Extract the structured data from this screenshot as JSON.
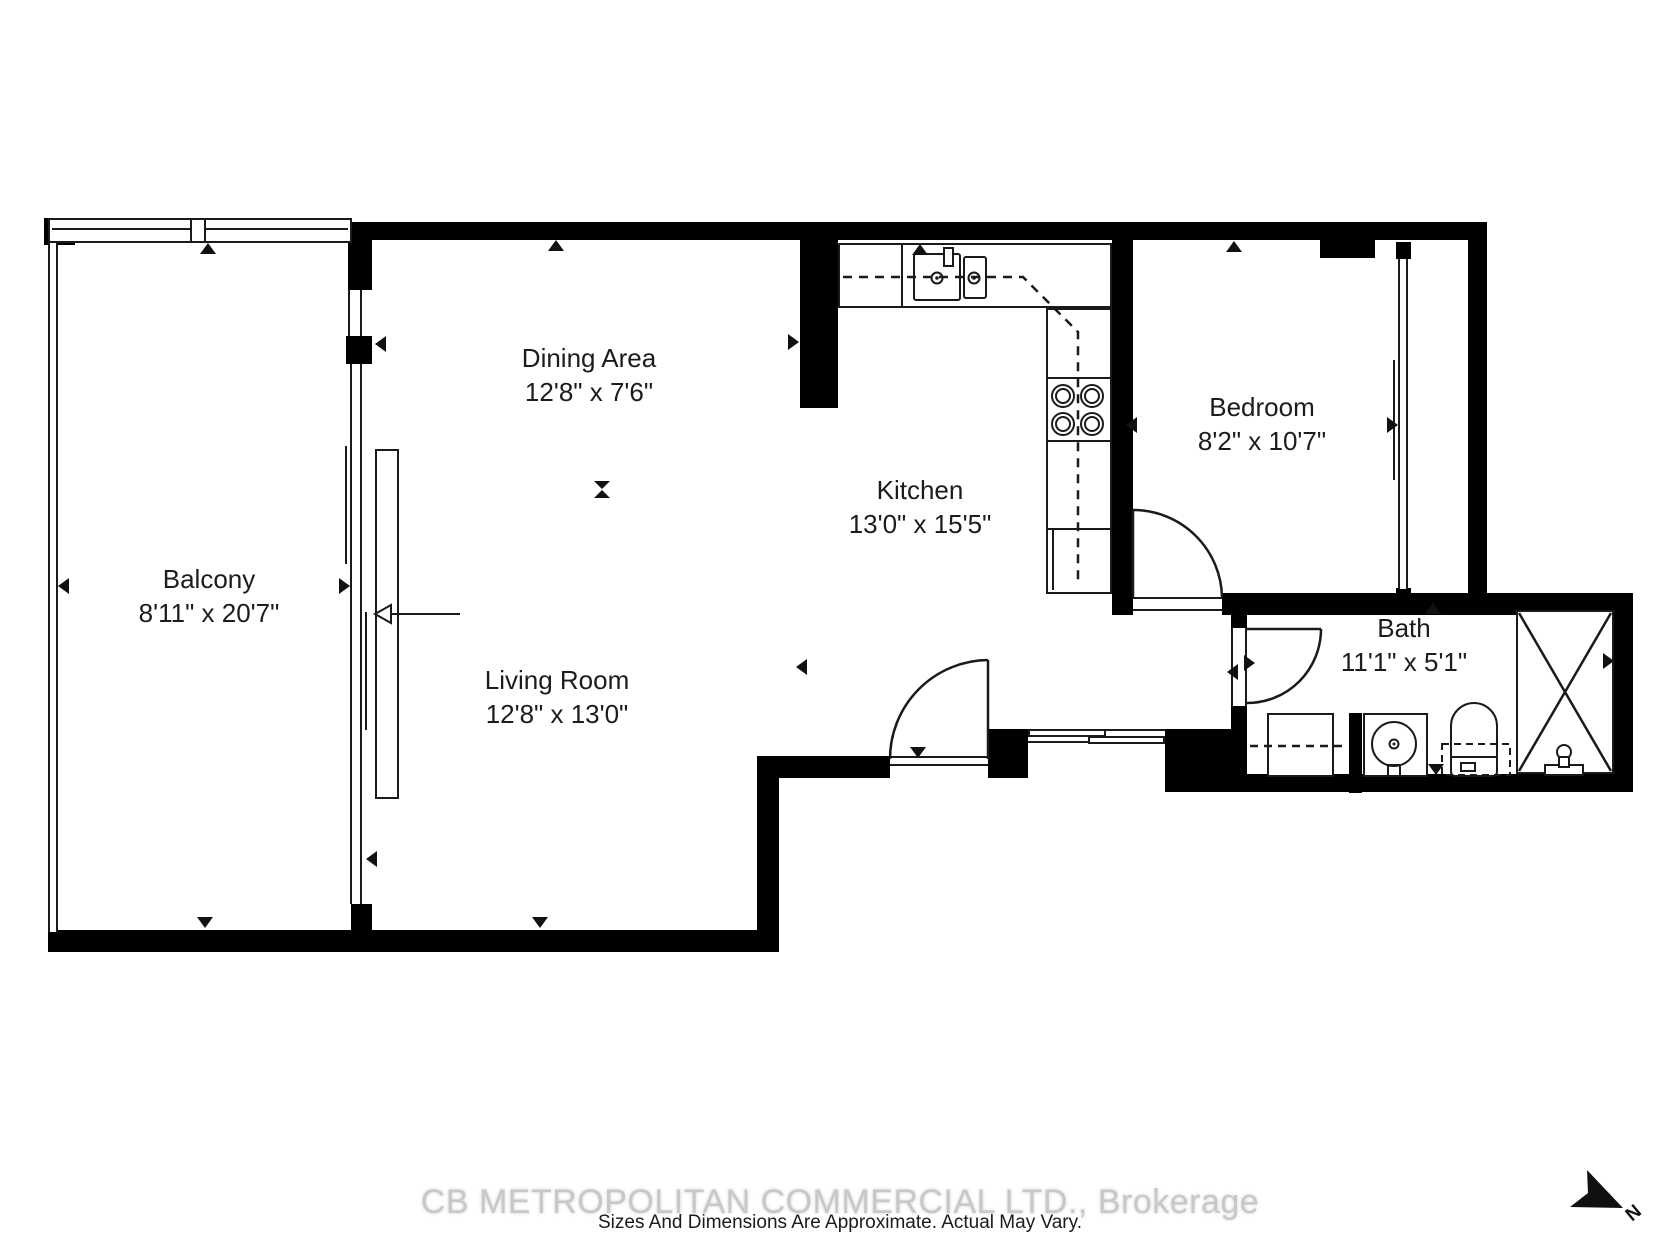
{
  "rooms": [
    {
      "name": "Balcony",
      "dims": "8'11\" x 20'7\""
    },
    {
      "name": "Dining Area",
      "dims": "12'8\" x 7'6\""
    },
    {
      "name": "Living Room",
      "dims": "12'8\" x 13'0\""
    },
    {
      "name": "Kitchen",
      "dims": "13'0\" x 15'5\""
    },
    {
      "name": "Bedroom",
      "dims": "8'2\" x 10'7\""
    },
    {
      "name": "Bath",
      "dims": "11'1\" x 5'1\""
    }
  ],
  "watermark": "CB METROPOLITAN COMMERCIAL LTD., Brokerage",
  "disclaimer": "Sizes And Dimensions Are Approximate. Actual May Vary.",
  "compass": {
    "label": "N"
  },
  "icons": {
    "north_arrow": "arrowhead-pointing-southeast",
    "direction_marker": "solid-triangle",
    "door": "quarter-circle-swing",
    "shower": "crossed-diagonals"
  },
  "colors": {
    "wall": "#000000",
    "line": "#1a1a1a",
    "text": "#1c1c1c",
    "watermark": "#c8c8c8",
    "background": "#ffffff"
  }
}
